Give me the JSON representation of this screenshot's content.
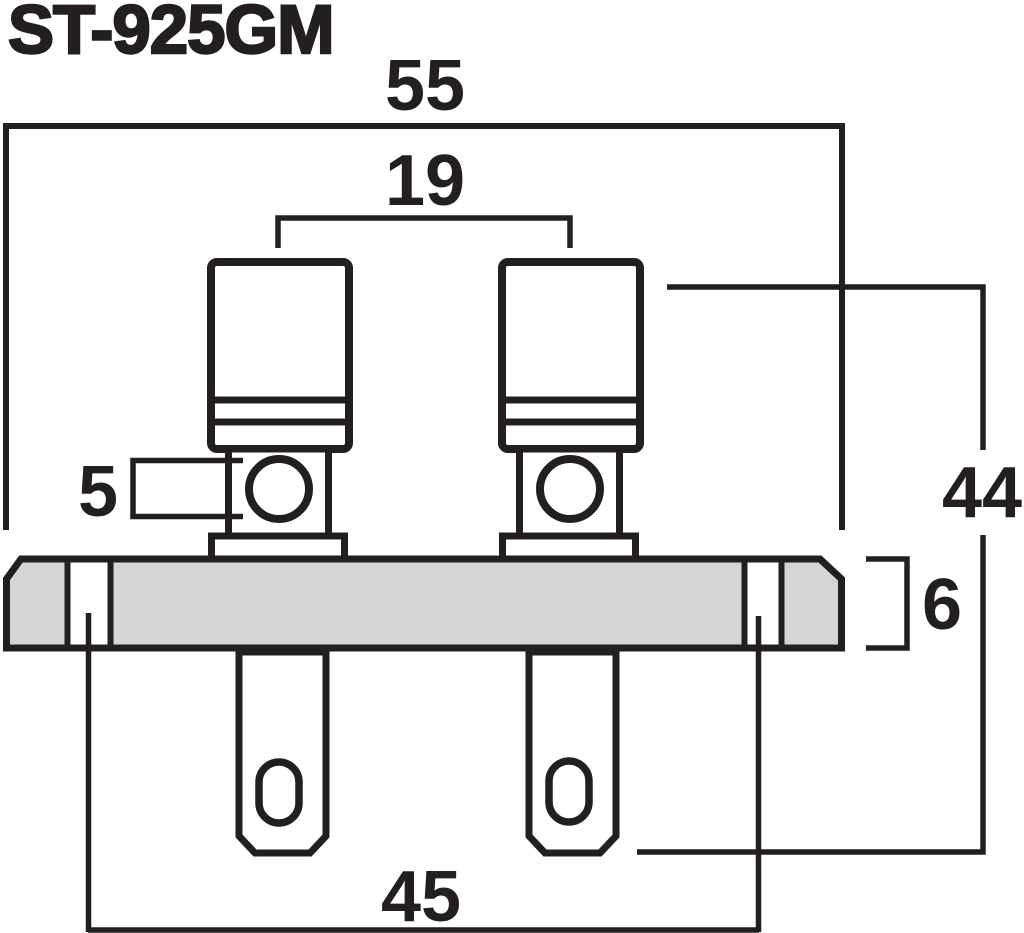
{
  "title": "ST-925GM",
  "dimensions": {
    "overall_width": "55",
    "post_spacing": "19",
    "terminal_hole_diameter": "5",
    "overall_height": "44",
    "plate_thickness": "6",
    "mounting_hole_spacing": "45"
  },
  "colors": {
    "line": "#231f20",
    "plate_fill": "#d4d6d4",
    "background": "#ffffff"
  }
}
